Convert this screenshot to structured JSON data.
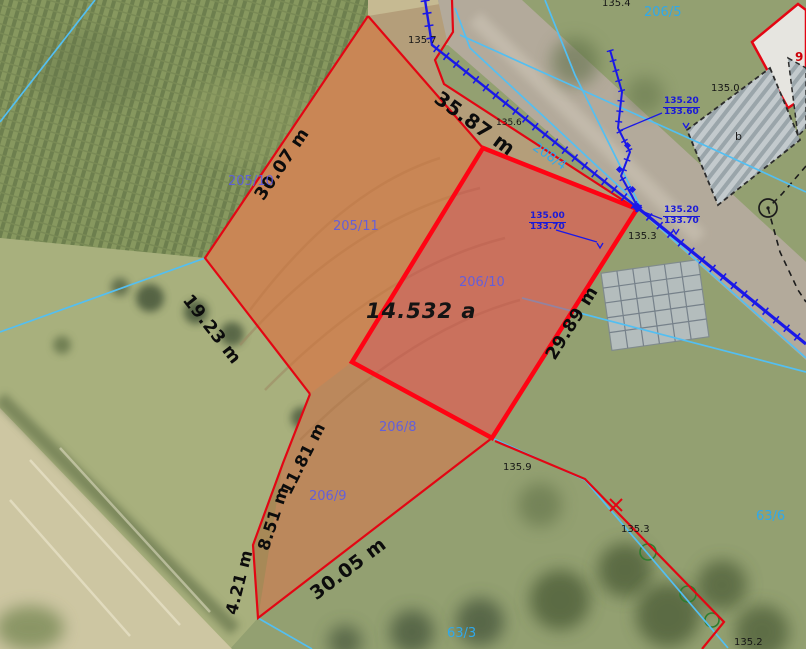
{
  "map": {
    "type": "cadastral-orthophoto",
    "selected_parcel": {
      "number": "206/10",
      "area": "14.532 a"
    },
    "measurements": [
      {
        "text": "35.87 m"
      },
      {
        "text": "30.07 m"
      },
      {
        "text": "19.23 m"
      },
      {
        "text": "11.81 m"
      },
      {
        "text": "8.51 m"
      },
      {
        "text": "4.21 m"
      },
      {
        "text": "30.05 m"
      },
      {
        "text": "29.89 m"
      }
    ],
    "parcels_blue": [
      {
        "text": "205/10"
      },
      {
        "text": "205/11"
      },
      {
        "text": "206/10"
      },
      {
        "text": "206/9"
      },
      {
        "text": "206/8"
      }
    ],
    "parcels_cyan": [
      {
        "text": "206/5"
      },
      {
        "text": "208/4"
      },
      {
        "text": "63/6"
      },
      {
        "text": "63/3"
      }
    ],
    "elevations_black": [
      {
        "text": "135.4"
      },
      {
        "text": "135.7"
      },
      {
        "text": "135.6"
      },
      {
        "text": "135.0"
      },
      {
        "text": "135.3"
      },
      {
        "text": "135.9"
      },
      {
        "text": "135.3"
      },
      {
        "text": "135.2"
      }
    ],
    "elevation_pairs": [
      {
        "top": "135.20",
        "bottom": "133.60"
      },
      {
        "top": "135.20",
        "bottom": "133.70"
      },
      {
        "top": "135.00",
        "bottom": "133.70"
      }
    ],
    "buildings": [
      {
        "label": "9"
      },
      {
        "label": "b"
      }
    ],
    "colors": {
      "boundary_red": "#e30613",
      "selected_stroke": "#ff0313",
      "selected_fill": "rgba(228,58,58,0.45)",
      "highlight_fill": "rgba(222,110,48,0.5)",
      "survey_blue": "#1a18e8",
      "cadastral_cyan": "#53bff2",
      "parcel_text_blue": "#5c5ce4",
      "parcel_text_cyan": "#2fa9ec"
    }
  }
}
